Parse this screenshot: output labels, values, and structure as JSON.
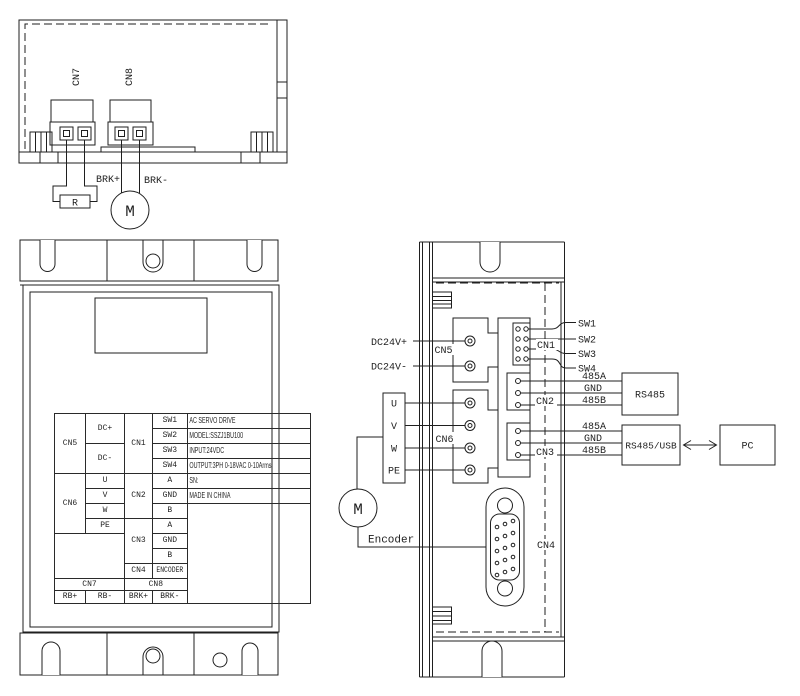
{
  "colors": {
    "line": "#1f1f1f",
    "background": "#ffffff"
  },
  "top_view": {
    "cn7": "CN7",
    "cn8": "CN8",
    "brk_plus": "BRK+",
    "brk_minus": "BRK-",
    "resistor": "R",
    "motor": "M"
  },
  "front_view": {
    "table": {
      "cn5": "CN5",
      "cn6": "CN6",
      "dc_plus": "DC+",
      "dc_minus": "DC-",
      "u": "U",
      "v": "V",
      "w": "W",
      "pe": "PE",
      "cn1": "CN1",
      "cn2": "CN2",
      "cn3": "CN3",
      "cn4": "CN4",
      "sw1": "SW1",
      "sw2": "SW2",
      "sw3": "SW3",
      "sw4": "SW4",
      "a1": "A",
      "gnd1": "GND",
      "b1": "B",
      "a2": "A",
      "gnd2": "GND",
      "b2": "B",
      "encoder": "ENCODER",
      "cn7": "CN7",
      "cn8": "CN8",
      "rb_plus": "RB+",
      "rb_minus": "RB-",
      "brk_plus": "BRK+",
      "brk_minus": "BRK-",
      "info": [
        "AC SERVO DRIVE",
        "MODEL:SSZJ1BU100",
        "INPUT:24VDC",
        "OUTPUT:3PH 0-18VAC 0-10Arms",
        "SN:",
        "MADE IN CHINA"
      ]
    }
  },
  "side_view": {
    "dc24v_plus": "DC24V+",
    "dc24v_minus": "DC24V-",
    "cn5": "CN5",
    "cn6": "CN6",
    "u": "U",
    "v": "V",
    "w": "W",
    "pe": "PE",
    "motor": "M",
    "encoder": "Encoder",
    "cn1": "CN1",
    "sw1": "SW1",
    "sw2": "SW2",
    "sw3": "SW3",
    "sw4": "SW4",
    "cn2": "CN2",
    "cn2_485a": "485A",
    "cn2_gnd": "GND",
    "cn2_485b": "485B",
    "cn3": "CN3",
    "cn3_485a": "485A",
    "cn3_gnd": "GND",
    "cn3_485b": "485B",
    "cn4": "CN4",
    "rs485": "RS485",
    "rs485_usb": "RS485/USB",
    "pc": "PC"
  }
}
